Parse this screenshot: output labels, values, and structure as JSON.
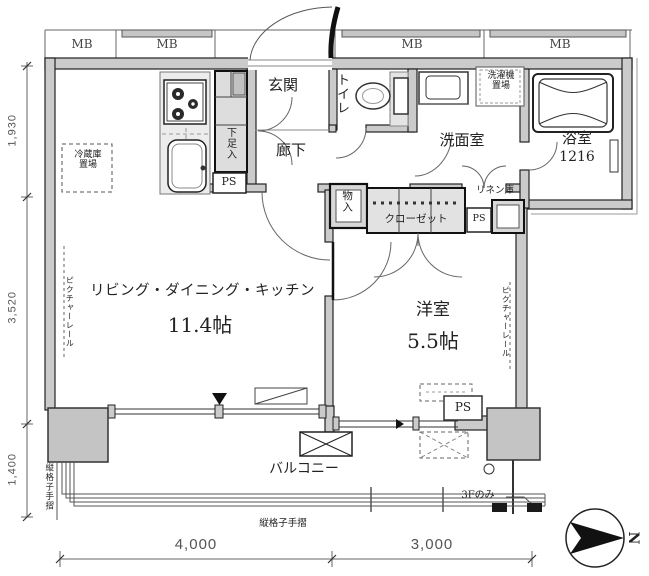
{
  "floor_plan": {
    "meter_boxes": [
      "MB",
      "MB",
      "MB",
      "MB"
    ],
    "rooms": {
      "entrance": "玄関",
      "hallway": "廊下",
      "toilet": "トイレ",
      "washroom": "洗面室",
      "bathroom": "浴室",
      "bathroom_size": "1216",
      "ldk": "リビング・ダイニング・キッチン",
      "ldk_size": "11.4帖",
      "western_room": "洋室",
      "western_room_size": "5.5帖",
      "balcony": "バルコニー"
    },
    "storage": {
      "shoe_cabinet": "下足入",
      "storage_closet": "物入",
      "closet": "クローゼット",
      "linen_closet": "リネン庫",
      "refrigerator_line1": "冷蔵庫",
      "refrigerator_line2": "置場",
      "washer_line1": "洗濯機",
      "washer_line2": "置場"
    },
    "labels": {
      "ps": "PS",
      "picture_rail": "ピクチャーレール",
      "lattice_handrail": "縦格子手摺",
      "third_floor_only": "3Fのみ",
      "compass_north": "N"
    },
    "dimensions": {
      "left": [
        "1,930",
        "3,520",
        "1,400"
      ],
      "bottom": [
        "4,000",
        "3,000"
      ]
    }
  }
}
